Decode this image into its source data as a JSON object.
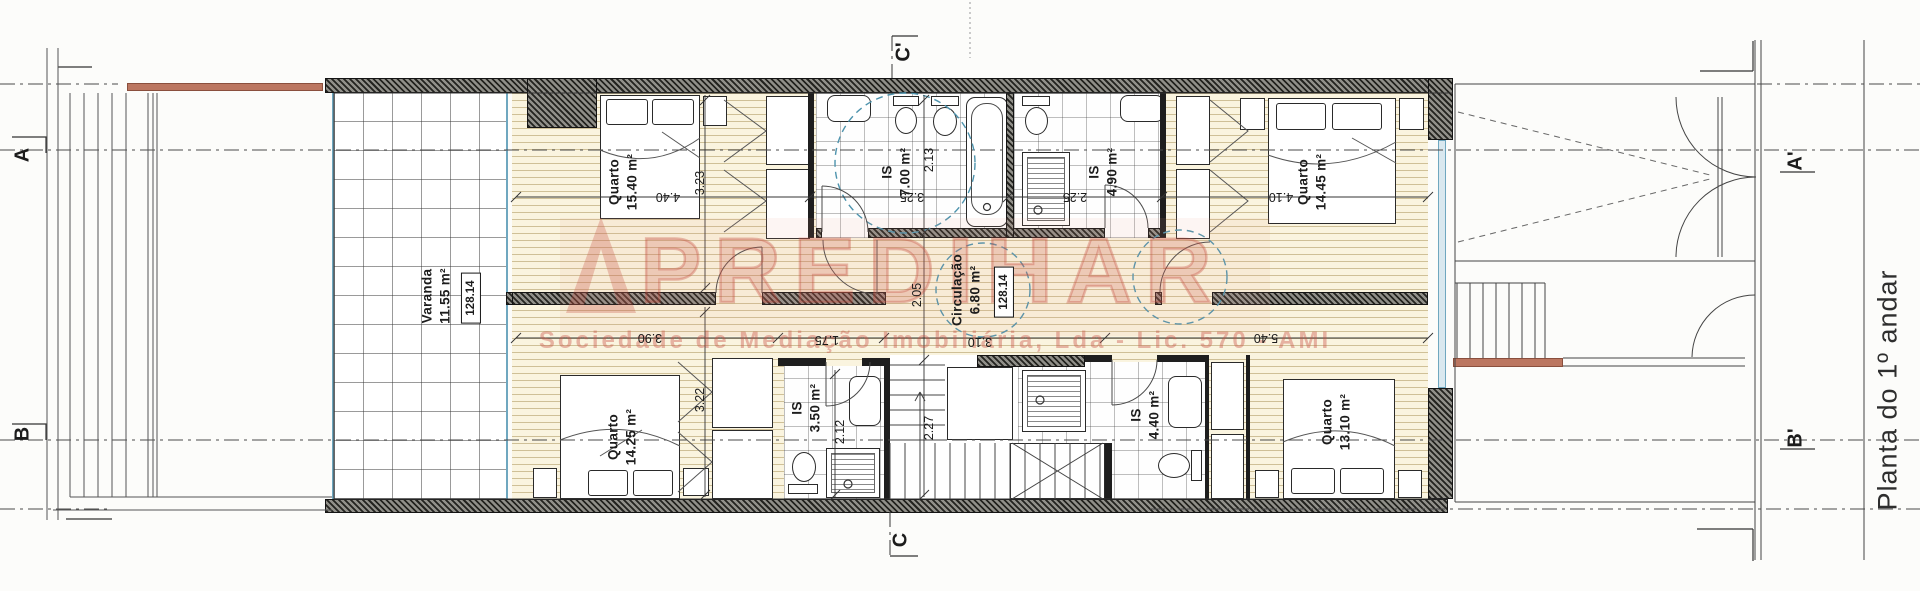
{
  "title": {
    "text": "Planta do 1º andar"
  },
  "watermark": {
    "brand": "PREDIHAR",
    "subtext": "Sociedade de Mediação Imobiliária, Lda - Lic. 570 - AMI"
  },
  "section_markers": {
    "a": "A",
    "a_prime": "A'",
    "b": "B",
    "b_prime": "B'",
    "c": "C",
    "c_prime": "C'"
  },
  "rooms": {
    "varanda": {
      "name": "Varanda",
      "area": "11.55 m²",
      "ref": "128.14"
    },
    "quarto_nw": {
      "name": "Quarto",
      "area": "15.40 m²",
      "dim_w": "4.40",
      "dim_h": "3.23"
    },
    "is_nw": {
      "name": "IS",
      "area": "7.00 m²",
      "dim_w": "3.25",
      "dim_h": "2.13"
    },
    "is_ne": {
      "name": "IS",
      "area": "4.90 m²",
      "dim_w": "2.25"
    },
    "quarto_ne": {
      "name": "Quarto",
      "area": "14.45 m²",
      "dim_w": "4.10"
    },
    "circulacao": {
      "name": "Circulação",
      "area": "6.80 m²",
      "ref": "128.14",
      "dim_h": "2.05",
      "dim_w": "3.10",
      "dim_w2": "1.75"
    },
    "quarto_sw": {
      "name": "Quarto",
      "area": "14.25 m²",
      "dim_w": "3.90",
      "dim_h": "3.22"
    },
    "is_sw": {
      "name": "IS",
      "area": "3.50 m²",
      "dim_h": "2.12"
    },
    "stairs": {
      "dim_h": "2.27"
    },
    "is_se": {
      "name": "IS",
      "area": "4.40 m²"
    },
    "quarto_se": {
      "name": "Quarto",
      "area": "13.10 m²",
      "dim_w": "5.40"
    }
  },
  "colors": {
    "wall": "#2b2b2b",
    "floor_line": "#c9b97f",
    "glazing": "#6fa7bf",
    "railing": "#bb7660",
    "survey_circle": "#4d93ad",
    "watermark": "#c85548"
  }
}
